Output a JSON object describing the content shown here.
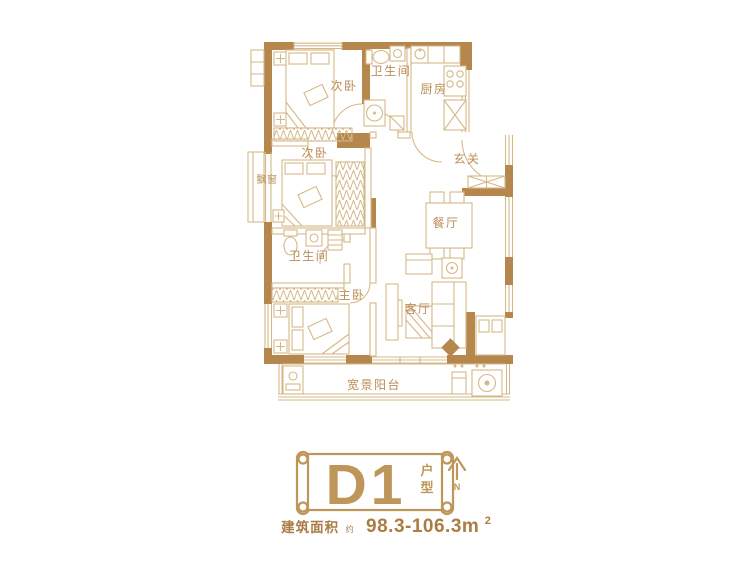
{
  "plan": {
    "rooms": [
      {
        "id": "bedroom-top",
        "label": "次卧"
      },
      {
        "id": "bathroom-top",
        "label": "卫生间"
      },
      {
        "id": "kitchen",
        "label": "厨房"
      },
      {
        "id": "bedroom-mid",
        "label": "次卧"
      },
      {
        "id": "bay-window",
        "label": "飘窗"
      },
      {
        "id": "entry-hall",
        "label": "玄关"
      },
      {
        "id": "dining-room",
        "label": "餐厅"
      },
      {
        "id": "bathroom-mid",
        "label": "卫生间"
      },
      {
        "id": "master-bedroom",
        "label": "主卧"
      },
      {
        "id": "living-room",
        "label": "客厅"
      },
      {
        "id": "balcony",
        "label": "宽景阳台"
      }
    ]
  },
  "banner": {
    "unit_name": "D1",
    "unit_type_vertical": [
      "户",
      "型"
    ],
    "north_label": "N"
  },
  "area": {
    "label": "建筑面积",
    "approx": "约",
    "value": "98.3-106.3m",
    "superscript": "2"
  },
  "colors": {
    "wall": "#b5874d",
    "line": "#d6b788",
    "label": "#ba8e57",
    "accent": "#bf9659",
    "dark": "#ab7c44"
  }
}
